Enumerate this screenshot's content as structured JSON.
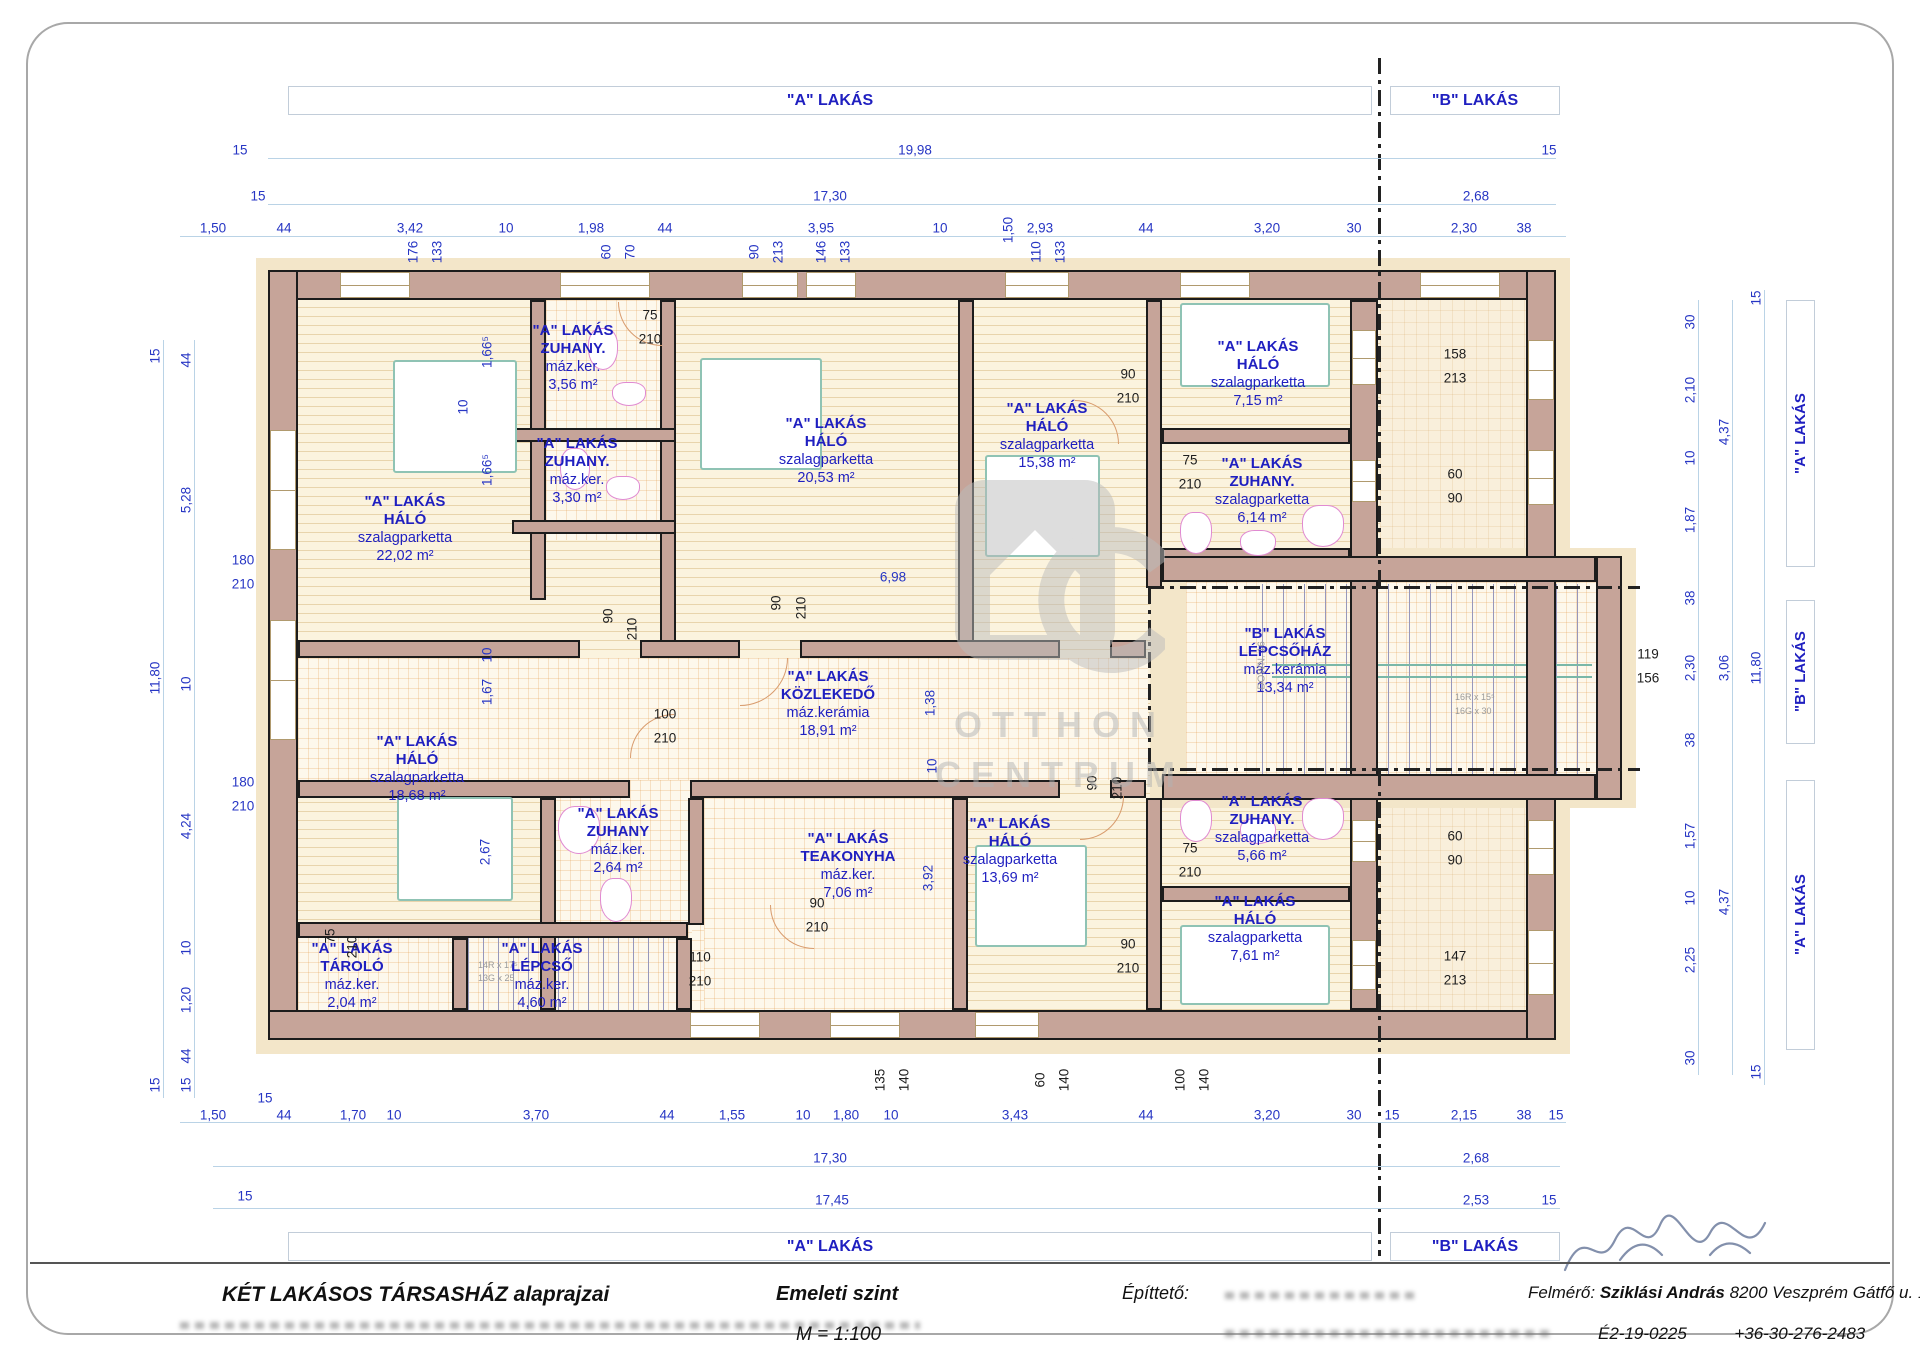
{
  "banners": {
    "top_a": "\"A\" LAKÁS",
    "top_b": "\"B\" LAKÁS",
    "bottom_a": "\"A\" LAKÁS",
    "bottom_b": "\"B\" LAKÁS",
    "right": [
      {
        "label": "\"A\" LAKÁS"
      },
      {
        "label": "\"B\" LAKÁS"
      },
      {
        "label": "\"A\" LAKÁS"
      }
    ]
  },
  "watermark": {
    "line1": "OTTHON",
    "line2": "CENTRUM"
  },
  "stair_notes": {
    "down": "DOWN. 16",
    "b1": "16R x 15⁵",
    "b2": "16G x 30",
    "a1": "14R x 17⁵",
    "a2": "13G x 25"
  },
  "title_block": {
    "project": "KÉT LAKÁSOS TÁRSASHÁZ alaprajzai",
    "level": "Emeleti szint",
    "scale": "M = 1:100",
    "client_label": "Építtető:",
    "surveyor_label": "Felmérő:",
    "surveyor_name": "Sziklási András",
    "surveyor_address": "8200 Veszprém Gátfő u. 1.",
    "surveyor_id": "É2-19-0225",
    "surveyor_phone": "+36-30-276-2483"
  },
  "rooms": [
    {
      "apt": "\"A\" LAKÁS",
      "name": "ZUHANY.",
      "floor": "máz.ker.",
      "area": "3,56 m²",
      "x": 573,
      "y": 322
    },
    {
      "apt": "\"A\" LAKÁS",
      "name": "ZUHANY.",
      "floor": "máz.ker.",
      "area": "3,30 m²",
      "x": 577,
      "y": 435
    },
    {
      "apt": "\"A\" LAKÁS",
      "name": "HÁLÓ",
      "floor": "szalagparketta",
      "area": "22,02 m²",
      "x": 405,
      "y": 493
    },
    {
      "apt": "\"A\" LAKÁS",
      "name": "HÁLÓ",
      "floor": "szalagparketta",
      "area": "20,53 m²",
      "x": 826,
      "y": 415
    },
    {
      "apt": "\"A\" LAKÁS",
      "name": "HÁLÓ",
      "floor": "szalagparketta",
      "area": "15,38 m²",
      "x": 1047,
      "y": 400
    },
    {
      "apt": "\"A\" LAKÁS",
      "name": "HÁLÓ",
      "floor": "szalagparketta",
      "area": "7,15 m²",
      "x": 1258,
      "y": 338
    },
    {
      "apt": "\"A\" LAKÁS",
      "name": "ZUHANY.",
      "floor": "szalagparketta",
      "area": "6,14 m²",
      "x": 1262,
      "y": 455
    },
    {
      "apt": "\"A\" LAKÁS",
      "name": "KÖZLEKEDŐ",
      "floor": "máz.kerámia",
      "area": "18,91 m²",
      "x": 828,
      "y": 668
    },
    {
      "apt": "\"B\" LAKÁS",
      "name": "LÉPCSŐHÁZ",
      "floor": "máz.kerámia",
      "area": "13,34 m²",
      "x": 1285,
      "y": 625
    },
    {
      "apt": "\"A\" LAKÁS",
      "name": "HÁLÓ",
      "floor": "szalagparketta",
      "area": "18,68 m²",
      "x": 417,
      "y": 733
    },
    {
      "apt": "\"A\" LAKÁS",
      "name": "ZUHANY",
      "floor": "máz.ker.",
      "area": "2,64 m²",
      "x": 618,
      "y": 805
    },
    {
      "apt": "\"A\" LAKÁS",
      "name": "TEAKONYHA",
      "floor": "máz.ker.",
      "area": "7,06 m²",
      "x": 848,
      "y": 830
    },
    {
      "apt": "\"A\" LAKÁS",
      "name": "HÁLÓ",
      "floor": "szalagparketta",
      "area": "13,69 m²",
      "x": 1010,
      "y": 815
    },
    {
      "apt": "\"A\" LAKÁS",
      "name": "ZUHANY.",
      "floor": "szalagparketta",
      "area": "5,66 m²",
      "x": 1262,
      "y": 793
    },
    {
      "apt": "\"A\" LAKÁS",
      "name": "HÁLÓ",
      "floor": "szalagparketta",
      "area": "7,61 m²",
      "x": 1255,
      "y": 893
    },
    {
      "apt": "\"A\" LAKÁS",
      "name": "TÁROLÓ",
      "floor": "máz.ker.",
      "area": "2,04 m²",
      "x": 352,
      "y": 940
    },
    {
      "apt": "\"A\" LAKÁS",
      "name": "LÉPCSŐ",
      "floor": "máz.ker.",
      "area": "4,60 m²",
      "x": 542,
      "y": 940
    }
  ],
  "dims": [
    {
      "t": "15",
      "x": 240,
      "y": 150
    },
    {
      "t": "19,98",
      "x": 915,
      "y": 150
    },
    {
      "t": "15",
      "x": 1549,
      "y": 150
    },
    {
      "t": "15",
      "x": 258,
      "y": 196
    },
    {
      "t": "17,30",
      "x": 830,
      "y": 196
    },
    {
      "t": "2,68",
      "x": 1476,
      "y": 196
    },
    {
      "t": "1,50",
      "x": 213,
      "y": 228
    },
    {
      "t": "44",
      "x": 284,
      "y": 228
    },
    {
      "t": "3,42",
      "x": 410,
      "y": 228
    },
    {
      "t": "10",
      "x": 506,
      "y": 228
    },
    {
      "t": "1,98",
      "x": 591,
      "y": 228
    },
    {
      "t": "44",
      "x": 665,
      "y": 228
    },
    {
      "t": "3,95",
      "x": 821,
      "y": 228
    },
    {
      "t": "10",
      "x": 940,
      "y": 228
    },
    {
      "t": "2,93",
      "x": 1040,
      "y": 228
    },
    {
      "t": "44",
      "x": 1146,
      "y": 228
    },
    {
      "t": "3,20",
      "x": 1267,
      "y": 228
    },
    {
      "t": "30",
      "x": 1354,
      "y": 228
    },
    {
      "t": "2,30",
      "x": 1464,
      "y": 228
    },
    {
      "t": "38",
      "x": 1524,
      "y": 228
    },
    {
      "t": "1,50",
      "x": 1008,
      "y": 230,
      "r": 1
    },
    {
      "t": "176",
      "x": 413,
      "y": 252,
      "r": 1
    },
    {
      "t": "133",
      "x": 437,
      "y": 252,
      "r": 1
    },
    {
      "t": "60",
      "x": 606,
      "y": 252,
      "r": 1
    },
    {
      "t": "70",
      "x": 630,
      "y": 252,
      "r": 1
    },
    {
      "t": "90",
      "x": 754,
      "y": 252,
      "r": 1
    },
    {
      "t": "213",
      "x": 778,
      "y": 252,
      "r": 1
    },
    {
      "t": "146",
      "x": 821,
      "y": 252,
      "r": 1
    },
    {
      "t": "133",
      "x": 845,
      "y": 252,
      "r": 1
    },
    {
      "t": "110",
      "x": 1036,
      "y": 252,
      "r": 1
    },
    {
      "t": "133",
      "x": 1060,
      "y": 252,
      "r": 1
    },
    {
      "t": "15",
      "x": 155,
      "y": 356,
      "r": 1
    },
    {
      "t": "44",
      "x": 186,
      "y": 360,
      "r": 1
    },
    {
      "t": "5,28",
      "x": 186,
      "y": 500,
      "r": 1
    },
    {
      "t": "11,80",
      "x": 155,
      "y": 678,
      "r": 1
    },
    {
      "t": "10",
      "x": 186,
      "y": 684,
      "r": 1
    },
    {
      "t": "4,24",
      "x": 186,
      "y": 826,
      "r": 1
    },
    {
      "t": "10",
      "x": 186,
      "y": 948,
      "r": 1
    },
    {
      "t": "1,20",
      "x": 186,
      "y": 1000,
      "r": 1
    },
    {
      "t": "44",
      "x": 186,
      "y": 1056,
      "r": 1
    },
    {
      "t": "15",
      "x": 155,
      "y": 1085,
      "r": 1
    },
    {
      "t": "15",
      "x": 186,
      "y": 1085,
      "r": 1
    },
    {
      "t": "180",
      "x": 243,
      "y": 560
    },
    {
      "t": "210",
      "x": 243,
      "y": 584
    },
    {
      "t": "180",
      "x": 243,
      "y": 782
    },
    {
      "t": "210",
      "x": 243,
      "y": 806
    },
    {
      "t": "1,66⁵",
      "x": 487,
      "y": 352,
      "r": 1
    },
    {
      "t": "10",
      "x": 463,
      "y": 407,
      "r": 1
    },
    {
      "t": "1,66⁵",
      "x": 487,
      "y": 470,
      "r": 1
    },
    {
      "t": "10",
      "x": 487,
      "y": 655,
      "r": 1
    },
    {
      "t": "1,67",
      "x": 487,
      "y": 692,
      "r": 1
    },
    {
      "t": "2,67",
      "x": 485,
      "y": 852,
      "r": 1
    },
    {
      "t": "75",
      "x": 330,
      "y": 936,
      "r": 1,
      "b": 1
    },
    {
      "t": "210",
      "x": 352,
      "y": 947,
      "r": 1,
      "b": 1
    },
    {
      "t": "75",
      "x": 650,
      "y": 315,
      "b": 1
    },
    {
      "t": "210",
      "x": 650,
      "y": 339,
      "b": 1
    },
    {
      "t": "90",
      "x": 1128,
      "y": 374,
      "b": 1
    },
    {
      "t": "210",
      "x": 1128,
      "y": 398,
      "b": 1
    },
    {
      "t": "75",
      "x": 1190,
      "y": 460,
      "b": 1
    },
    {
      "t": "210",
      "x": 1190,
      "y": 484,
      "b": 1
    },
    {
      "t": "90",
      "x": 776,
      "y": 603,
      "r": 1,
      "b": 1
    },
    {
      "t": "210",
      "x": 801,
      "y": 608,
      "r": 1,
      "b": 1
    },
    {
      "t": "90",
      "x": 608,
      "y": 616,
      "r": 1,
      "b": 1
    },
    {
      "t": "210",
      "x": 632,
      "y": 629,
      "r": 1,
      "b": 1
    },
    {
      "t": "100",
      "x": 665,
      "y": 714,
      "b": 1
    },
    {
      "t": "210",
      "x": 665,
      "y": 738,
      "b": 1
    },
    {
      "t": "90",
      "x": 1092,
      "y": 783,
      "r": 1,
      "b": 1
    },
    {
      "t": "210",
      "x": 1117,
      "y": 788,
      "r": 1,
      "b": 1
    },
    {
      "t": "90",
      "x": 817,
      "y": 903,
      "b": 1
    },
    {
      "t": "210",
      "x": 817,
      "y": 927,
      "b": 1
    },
    {
      "t": "110",
      "x": 700,
      "y": 957,
      "b": 1
    },
    {
      "t": "210",
      "x": 700,
      "y": 981,
      "b": 1
    },
    {
      "t": "75",
      "x": 1190,
      "y": 848,
      "b": 1
    },
    {
      "t": "210",
      "x": 1190,
      "y": 872,
      "b": 1
    },
    {
      "t": "90",
      "x": 1128,
      "y": 944,
      "b": 1
    },
    {
      "t": "210",
      "x": 1128,
      "y": 968,
      "b": 1
    },
    {
      "t": "6,98",
      "x": 893,
      "y": 577
    },
    {
      "t": "1,38",
      "x": 930,
      "y": 703,
      "r": 1
    },
    {
      "t": "10",
      "x": 932,
      "y": 766,
      "r": 1
    },
    {
      "t": "3,92",
      "x": 928,
      "y": 878,
      "r": 1
    },
    {
      "t": "158",
      "x": 1455,
      "y": 354,
      "b": 1
    },
    {
      "t": "213",
      "x": 1455,
      "y": 378,
      "b": 1
    },
    {
      "t": "60",
      "x": 1455,
      "y": 474,
      "b": 1
    },
    {
      "t": "90",
      "x": 1455,
      "y": 498,
      "b": 1
    },
    {
      "t": "119",
      "x": 1648,
      "y": 654,
      "b": 1
    },
    {
      "t": "156",
      "x": 1648,
      "y": 678,
      "b": 1
    },
    {
      "t": "60",
      "x": 1455,
      "y": 836,
      "b": 1
    },
    {
      "t": "90",
      "x": 1455,
      "y": 860,
      "b": 1
    },
    {
      "t": "147",
      "x": 1455,
      "y": 956,
      "b": 1
    },
    {
      "t": "213",
      "x": 1455,
      "y": 980,
      "b": 1
    },
    {
      "t": "30",
      "x": 1690,
      "y": 322,
      "r": 1
    },
    {
      "t": "2,10",
      "x": 1690,
      "y": 390,
      "r": 1
    },
    {
      "t": "10",
      "x": 1690,
      "y": 458,
      "r": 1
    },
    {
      "t": "1,87",
      "x": 1690,
      "y": 520,
      "r": 1
    },
    {
      "t": "38",
      "x": 1690,
      "y": 598,
      "r": 1
    },
    {
      "t": "2,30",
      "x": 1690,
      "y": 668,
      "r": 1
    },
    {
      "t": "38",
      "x": 1690,
      "y": 740,
      "r": 1
    },
    {
      "t": "1,57",
      "x": 1690,
      "y": 836,
      "r": 1
    },
    {
      "t": "10",
      "x": 1690,
      "y": 898,
      "r": 1
    },
    {
      "t": "2,25",
      "x": 1690,
      "y": 960,
      "r": 1
    },
    {
      "t": "30",
      "x": 1690,
      "y": 1058,
      "r": 1
    },
    {
      "t": "4,37",
      "x": 1724,
      "y": 432,
      "r": 1
    },
    {
      "t": "3,06",
      "x": 1724,
      "y": 668,
      "r": 1
    },
    {
      "t": "4,37",
      "x": 1724,
      "y": 902,
      "r": 1
    },
    {
      "t": "11,80",
      "x": 1756,
      "y": 668,
      "r": 1
    },
    {
      "t": "15",
      "x": 1756,
      "y": 298,
      "r": 1
    },
    {
      "t": "15",
      "x": 1756,
      "y": 1072,
      "r": 1
    },
    {
      "t": "135",
      "x": 880,
      "y": 1080,
      "r": 1,
      "b": 1
    },
    {
      "t": "140",
      "x": 904,
      "y": 1080,
      "r": 1,
      "b": 1
    },
    {
      "t": "60",
      "x": 1040,
      "y": 1080,
      "r": 1,
      "b": 1
    },
    {
      "t": "140",
      "x": 1064,
      "y": 1080,
      "r": 1,
      "b": 1
    },
    {
      "t": "100",
      "x": 1180,
      "y": 1080,
      "r": 1,
      "b": 1
    },
    {
      "t": "140",
      "x": 1204,
      "y": 1080,
      "r": 1,
      "b": 1
    },
    {
      "t": "15",
      "x": 265,
      "y": 1098
    },
    {
      "t": "1,50",
      "x": 213,
      "y": 1115
    },
    {
      "t": "44",
      "x": 284,
      "y": 1115
    },
    {
      "t": "1,70",
      "x": 353,
      "y": 1115
    },
    {
      "t": "10",
      "x": 394,
      "y": 1115
    },
    {
      "t": "3,70",
      "x": 536,
      "y": 1115
    },
    {
      "t": "44",
      "x": 667,
      "y": 1115
    },
    {
      "t": "1,55",
      "x": 732,
      "y": 1115
    },
    {
      "t": "10",
      "x": 803,
      "y": 1115
    },
    {
      "t": "1,80",
      "x": 846,
      "y": 1115
    },
    {
      "t": "10",
      "x": 891,
      "y": 1115
    },
    {
      "t": "3,43",
      "x": 1015,
      "y": 1115
    },
    {
      "t": "44",
      "x": 1146,
      "y": 1115
    },
    {
      "t": "3,20",
      "x": 1267,
      "y": 1115
    },
    {
      "t": "30",
      "x": 1354,
      "y": 1115
    },
    {
      "t": "15",
      "x": 1392,
      "y": 1115
    },
    {
      "t": "2,15",
      "x": 1464,
      "y": 1115
    },
    {
      "t": "38",
      "x": 1524,
      "y": 1115
    },
    {
      "t": "15",
      "x": 1556,
      "y": 1115
    },
    {
      "t": "17,30",
      "x": 830,
      "y": 1158
    },
    {
      "t": "2,68",
      "x": 1476,
      "y": 1158
    },
    {
      "t": "15",
      "x": 245,
      "y": 1196
    },
    {
      "t": "17,45",
      "x": 832,
      "y": 1200
    },
    {
      "t": "2,53",
      "x": 1476,
      "y": 1200
    },
    {
      "t": "15",
      "x": 1549,
      "y": 1200
    }
  ]
}
